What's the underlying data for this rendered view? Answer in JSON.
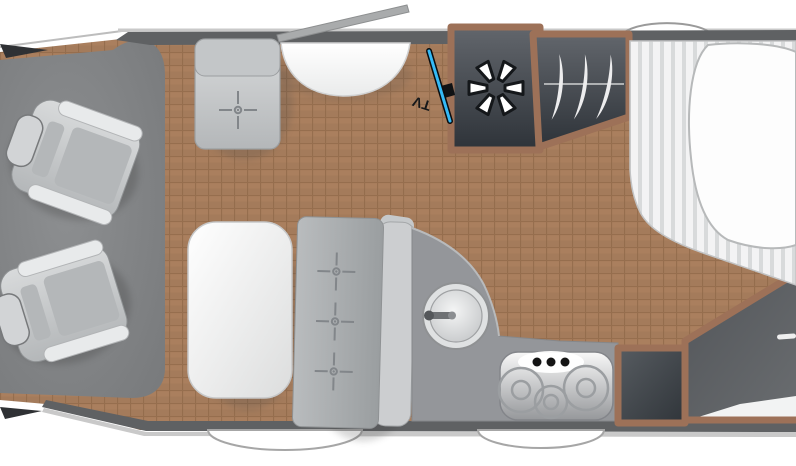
{
  "meta": {
    "title": "Motorhome floor plan — top view"
  },
  "labels": {
    "tv": "TV"
  },
  "colors": {
    "floor_tile": "#aa7f5e",
    "floor_grout": "#8e6848",
    "wall": "#5f6163",
    "cab_floor": "#838587",
    "furniture_frame": "#9d7158",
    "dark_interior": "#3a3f45",
    "accent_blue": "#35baf6",
    "upholstery": "#c7c9cb",
    "white_fixture": "#ffffff"
  },
  "features": {
    "cab": {
      "swivel_seats": 2,
      "wing_mirrors": 2
    },
    "lounge": {
      "single_travel_seat_belts": 1,
      "bench_travel_seat_belts": 3,
      "table": true
    },
    "entrance_door": true,
    "tv": {
      "mounted_diagonally": true
    },
    "kitchen": {
      "round_sink": true,
      "hob_burners": 3,
      "hob_knobs": 3,
      "cabinet": true
    },
    "shower": {
      "icon": "asterisk"
    },
    "wardrobe": {
      "hangers": 3
    },
    "bed": {
      "striped_mattress": true,
      "duvet": true
    },
    "washroom": {
      "corner_layout": true,
      "vanity": true
    },
    "wheel_arches": 3
  }
}
